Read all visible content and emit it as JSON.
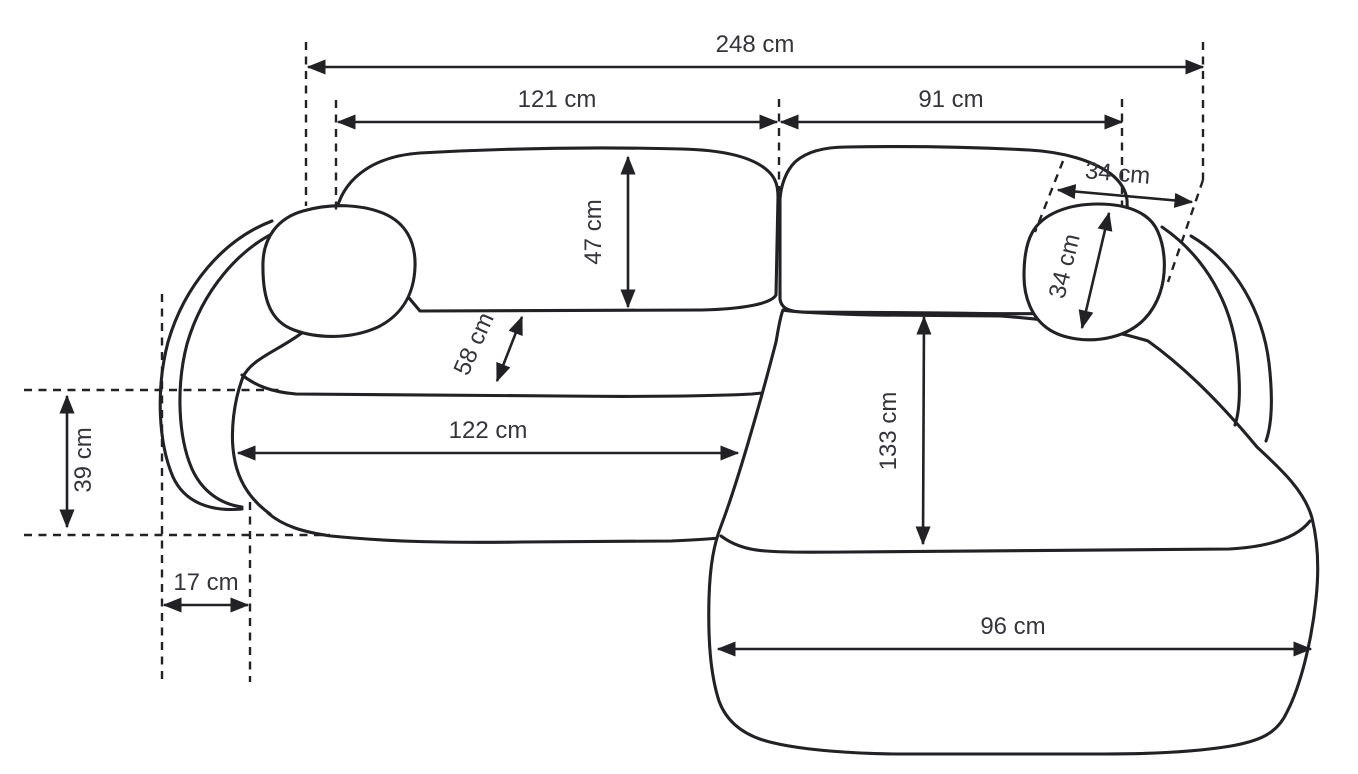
{
  "diagram": {
    "name": "corner-sofa-dimensions-top-view",
    "unit": "cm",
    "colors": {
      "background": "#ffffff",
      "line": "#212126",
      "text": "#34343c"
    },
    "dimensions": [
      {
        "id": "total-width",
        "label": "248 cm"
      },
      {
        "id": "left-section-width",
        "label": "121 cm"
      },
      {
        "id": "right-section-width",
        "label": "91 cm"
      },
      {
        "id": "backrest-depth",
        "label": "47 cm"
      },
      {
        "id": "seat-depth",
        "label": "58 cm"
      },
      {
        "id": "headrest-width",
        "label": "34 cm"
      },
      {
        "id": "headrest-depth",
        "label": "34 cm"
      },
      {
        "id": "seat-width",
        "label": "122 cm"
      },
      {
        "id": "chaise-length",
        "label": "133 cm"
      },
      {
        "id": "armrest-side-depth",
        "label": "39 cm"
      },
      {
        "id": "armrest-width",
        "label": "17 cm"
      },
      {
        "id": "chaise-width",
        "label": "96 cm"
      }
    ]
  }
}
